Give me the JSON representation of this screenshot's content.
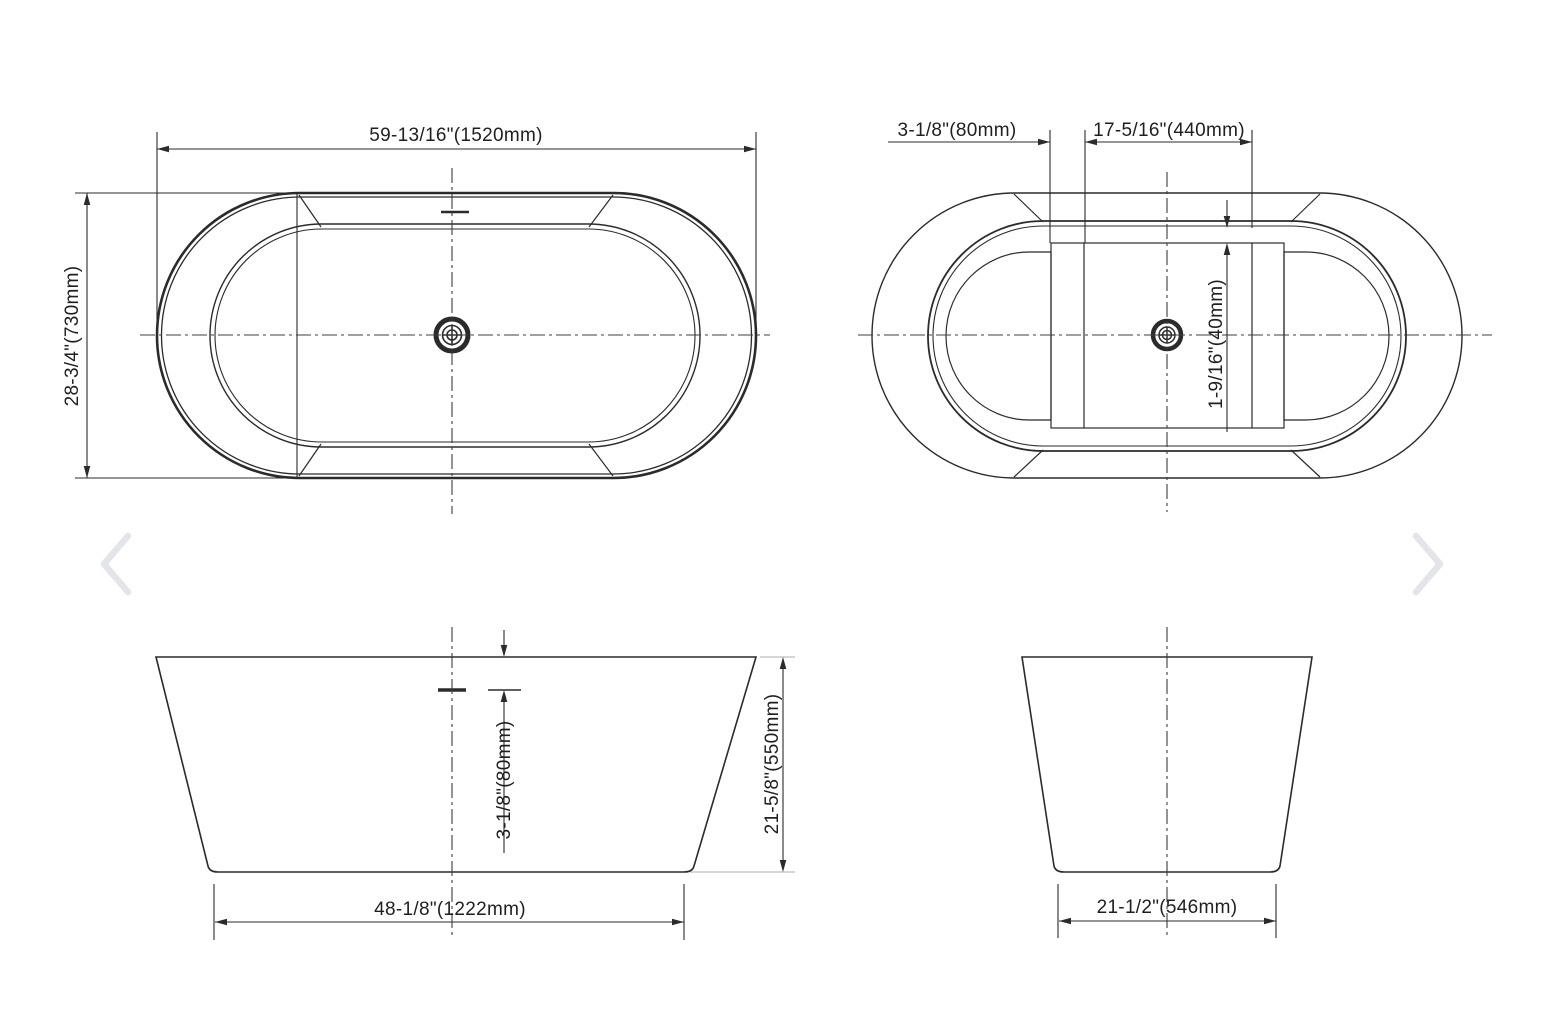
{
  "viewer": {
    "prev_icon": "chevron-left",
    "next_icon": "chevron-right"
  },
  "colors": {
    "background": "#ffffff",
    "ink": "#2b2b2b",
    "centerline": "#3d3d3d",
    "extension_gray": "#a9adb3",
    "chevron_gray": "#e3e5e9"
  },
  "drawing": {
    "subject": "freestanding oval bathtub dimension drawing",
    "views": {
      "plan": {
        "width_label": "59-13/16\"(1520mm)",
        "depth_label": "28-3/4\"(730mm)"
      },
      "underside": {
        "ledge_label": "3-1/8\"(80mm)",
        "panel_label": "17-5/16\"(440mm)",
        "rim_label": "1-9/16\"(40mm)"
      },
      "front": {
        "overflow_label": "3-1/8\"(80mm)",
        "height_label": "21-5/8\"(550mm)",
        "base_label": "48-1/8\"(1222mm)"
      },
      "side": {
        "base_label": "21-1/2\"(546mm)"
      }
    }
  }
}
